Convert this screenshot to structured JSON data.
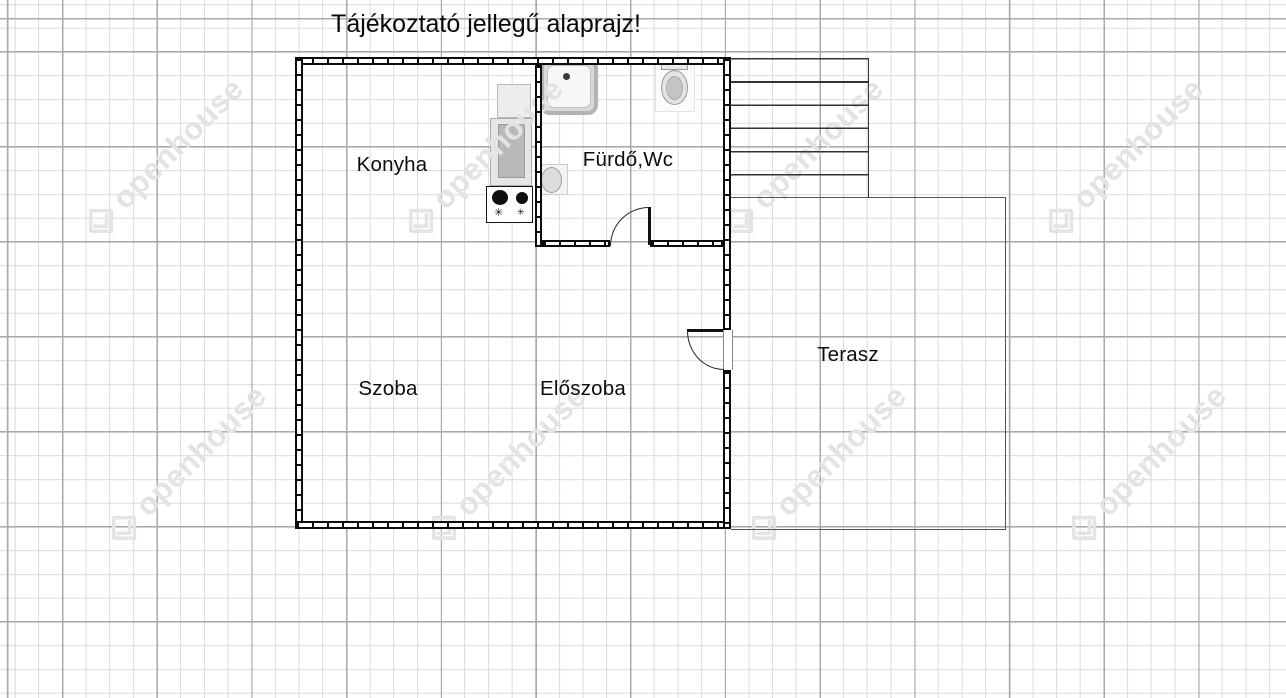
{
  "title": "Tájékoztató jellegű alaprajz!",
  "rooms": {
    "kitchen": "Konyha",
    "bathroom": "Fürdő,Wc",
    "living": "Szoba",
    "hall": "Előszoba",
    "terrace": "Terasz"
  },
  "watermark": {
    "text": "openhouse"
  },
  "symbols": {
    "burner_knob": "✳"
  },
  "colors": {
    "wall": "#0c0c0c",
    "grid_minor": "#dadada",
    "grid_major": "#a9a9a9",
    "watermark": "#e3e3e3",
    "fixture_gray": "#b9b9b9"
  }
}
